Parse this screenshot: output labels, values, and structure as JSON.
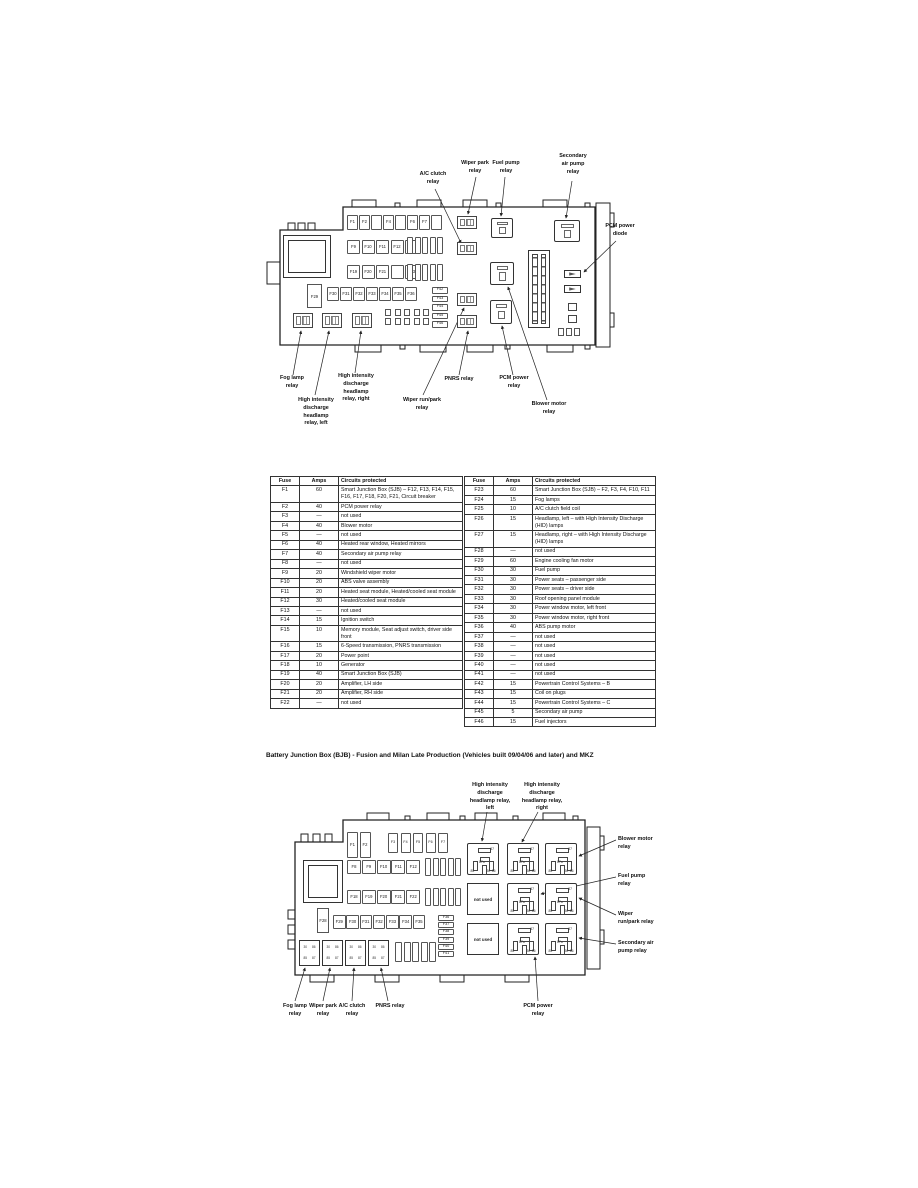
{
  "title": "Battery Junction Box (BJB) - Fusion and Milan Late Production (Vehicles built 09/04/06 and later) and MKZ",
  "labels": {
    "fog": "Fog lamp relay",
    "hid_left": "High intensity discharge headlamp relay, left",
    "hid_right": "High intensity discharge headlamp relay, right",
    "wiper_park": "Wiper park relay",
    "wiper_runpark": "Wiper run/park relay",
    "ac_clutch": "A/C clutch relay",
    "fuel_pump": "Fuel pump relay",
    "secondary_air": "Secondary air pump relay",
    "pcm_diode": "PCM power diode",
    "pcm_power": "PCM power relay",
    "pnrs": "PNRS relay",
    "blower": "Blower motor relay",
    "not_used": "not used"
  },
  "pins": {
    "p87": "87",
    "p87a": "87a",
    "p85": "85",
    "p86": "86",
    "p30": "30"
  },
  "module_pins": [
    "30",
    "86",
    "85",
    "87"
  ],
  "top_diagram": {
    "row1": [
      "F1",
      "F2",
      "",
      "F4",
      "",
      "F6",
      "F7",
      ""
    ],
    "row2": [
      "F9",
      "F10",
      "F11",
      "F12",
      ""
    ],
    "row3": [
      "F19",
      "F20",
      "F21",
      "",
      "F23"
    ],
    "row4": [
      "F30",
      "F31",
      "F32",
      "F33",
      "F34",
      "F35",
      "F36"
    ],
    "big_fuse": "F29",
    "hcol": [
      "F42",
      "F43",
      "F44",
      "F45",
      "F46"
    ]
  },
  "bottom_diagram": {
    "tall_pair": [
      "F1",
      "F2"
    ],
    "vrow1": [
      "F3",
      "F4",
      "F5",
      "F6",
      "F7"
    ],
    "row2": [
      "F8",
      "F9",
      "F10",
      "F11",
      "F12"
    ],
    "row3": [
      "F18",
      "F19",
      "F20",
      "F21",
      "F22"
    ],
    "big_fuse": "F28",
    "row4": [
      "F29",
      "F30",
      "F31",
      "F32",
      "F33",
      "F34",
      "F35"
    ],
    "hcol": [
      "F36",
      "F37",
      "F38",
      "F39",
      "F40",
      "F41"
    ]
  },
  "tables": {
    "headers": [
      "Fuse",
      "Amps",
      "Circuits protected"
    ],
    "left_rows": [
      [
        "F1",
        "60",
        "Smart Junction Box (SJB) – F12, F13, F14, F15, F16, F17, F18, F20, F21, Circuit breaker"
      ],
      [
        "F2",
        "40",
        "PCM power relay"
      ],
      [
        "F3",
        "—",
        "not used"
      ],
      [
        "F4",
        "40",
        "Blower motor"
      ],
      [
        "F5",
        "—",
        "not used"
      ],
      [
        "F6",
        "40",
        "Heated rear window, Heated mirrors"
      ],
      [
        "F7",
        "40",
        "Secondary air pump relay"
      ],
      [
        "F8",
        "—",
        "not used"
      ],
      [
        "F9",
        "20",
        "Windshield wiper motor"
      ],
      [
        "F10",
        "20",
        "ABS valve assembly"
      ],
      [
        "F11",
        "20",
        "Heated seat module, Heated/cooled seat module"
      ],
      [
        "F12",
        "30",
        "Heated/cooled seat module"
      ],
      [
        "F13",
        "—",
        "not used"
      ],
      [
        "F14",
        "15",
        "Ignition switch"
      ],
      [
        "F15",
        "10",
        "Memory module, Seat adjust switch, driver side front"
      ],
      [
        "F16",
        "15",
        "6-Speed transmission, PNRS transmission"
      ],
      [
        "F17",
        "20",
        "Power point"
      ],
      [
        "F18",
        "10",
        "Generator"
      ],
      [
        "F19",
        "40",
        "Smart Junction Box (SJB)"
      ],
      [
        "F20",
        "20",
        "Amplifier, LH side"
      ],
      [
        "F21",
        "20",
        "Amplifier, RH side"
      ],
      [
        "F22",
        "—",
        "not used"
      ]
    ],
    "right_rows": [
      [
        "F23",
        "60",
        "Smart Junction Box (SJB) – F2, F3, F4, F10, F11"
      ],
      [
        "F24",
        "15",
        "Fog lamps"
      ],
      [
        "F25",
        "10",
        "A/C clutch field coil"
      ],
      [
        "F26",
        "15",
        "Headlamp, left – with High Intensity Discharge (HID) lamps"
      ],
      [
        "F27",
        "15",
        "Headlamp, right – with High Intensity Discharge (HID) lamps"
      ],
      [
        "F28",
        "—",
        "not used"
      ],
      [
        "F29",
        "60",
        "Engine cooling fan motor"
      ],
      [
        "F30",
        "30",
        "Fuel pump"
      ],
      [
        "F31",
        "30",
        "Power seats – passenger side"
      ],
      [
        "F32",
        "30",
        "Power seats – driver side"
      ],
      [
        "F33",
        "30",
        "Roof opening panel module"
      ],
      [
        "F34",
        "30",
        "Power window motor, left front"
      ],
      [
        "F35",
        "30",
        "Power window motor, right front"
      ],
      [
        "F36",
        "40",
        "ABS pump motor"
      ],
      [
        "F37",
        "—",
        "not used"
      ],
      [
        "F38",
        "—",
        "not used"
      ],
      [
        "F39",
        "—",
        "not used"
      ],
      [
        "F40",
        "—",
        "not used"
      ],
      [
        "F41",
        "—",
        "not used"
      ],
      [
        "F42",
        "15",
        "Powertrain Control Systems – B"
      ],
      [
        "F43",
        "15",
        "Coil on plugs"
      ],
      [
        "F44",
        "15",
        "Powertrain Control Systems – C"
      ],
      [
        "F45",
        "5",
        "Secondary air pump"
      ],
      [
        "F46",
        "15",
        "Fuel injectors"
      ]
    ]
  }
}
